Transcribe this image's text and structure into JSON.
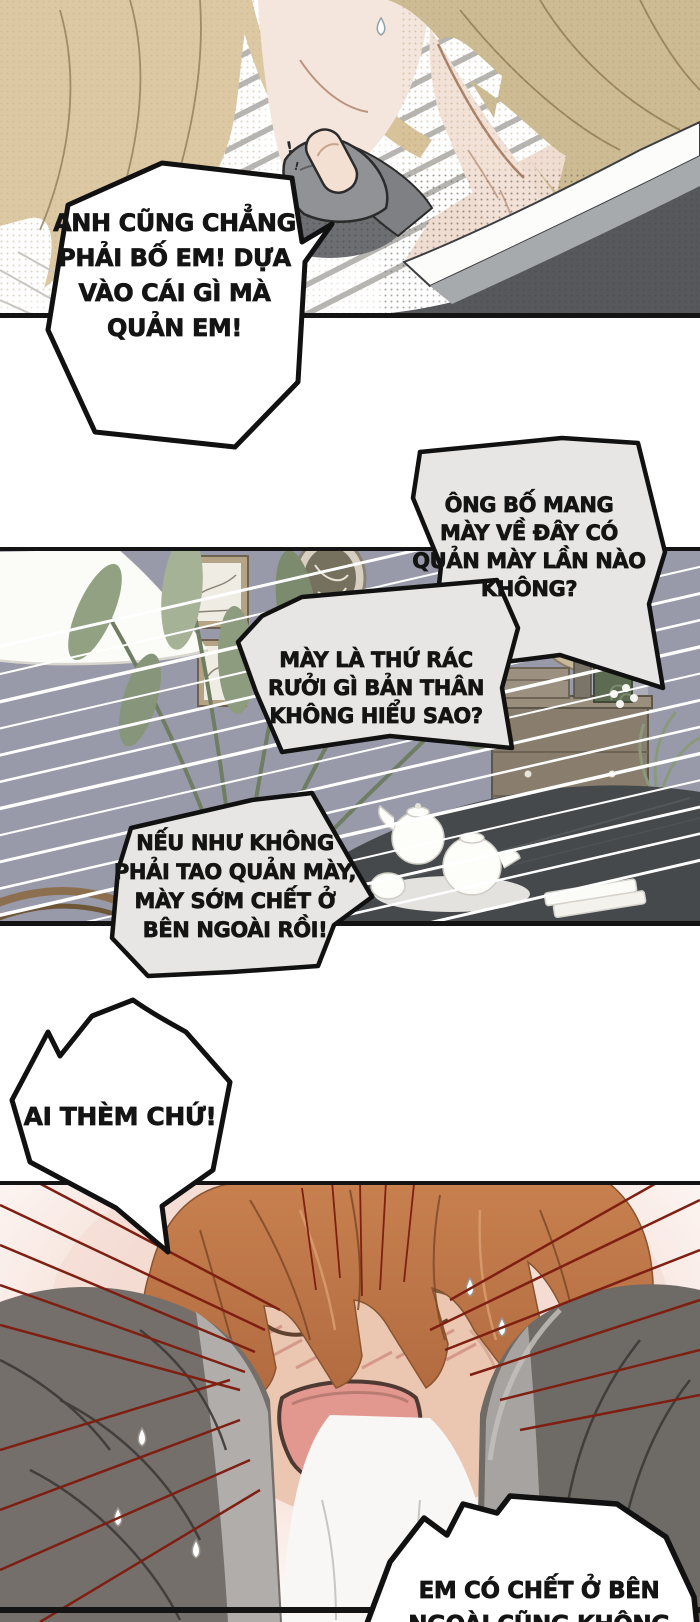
{
  "bubbles": {
    "b1": {
      "text": "ANH CŨNG CHẲNG\nPHẢI BỐ EM! DỰA\nVÀO CÁI GÌ MÀ\nQUẢN EM!"
    },
    "b2": {
      "text": "ÔNG BỐ MANG\nMÀY VỀ ĐÂY CÓ\nQUẢN MÀY LẦN NÀO\nKHÔNG?"
    },
    "b3": {
      "text": "MÀY LÀ THỨ RÁC\nRƯỞI GÌ BẢN THÂN\nKHÔNG HIỂU SAO?"
    },
    "b4": {
      "text": "NẾU NHƯ KHÔNG\nPHẢI TAO QUẢN MÀY,\nMÀY SỚM CHẾT Ở\nBÊN NGOÀI RỒI!"
    },
    "b5": {
      "text": "AI THÈM CHỨ!"
    },
    "b6": {
      "text": "EM CÓ CHẾT Ở BÊN\nNGOÀI CŨNG KHÔNG"
    }
  },
  "sfx": {
    "surprise_mark": "!"
  },
  "colors": {
    "panel_border": "#141414",
    "bubble_gray": "#e7e6e4",
    "bubble_white": "#ffffff",
    "wall_purple_gray": "#999aa9",
    "speed_line_white": "#ffffff",
    "speed_line_red": "#7e1f12",
    "hair_blonde": "#dcc9a3",
    "hair_tan": "#cdbb93",
    "hair_orange": "#c4794a",
    "skin": "#f2e1d7",
    "blush_pink": "#d08e80",
    "mouth_pink": "#e3988f",
    "jacket_dark_top": "#57585c",
    "jacket_dark_bottom": "#6e6a66",
    "collar_gray": "#a6aaad",
    "plant_green": "#8d9b7e",
    "table_dark": "#46494b",
    "wood_tan": "#b4a384"
  }
}
